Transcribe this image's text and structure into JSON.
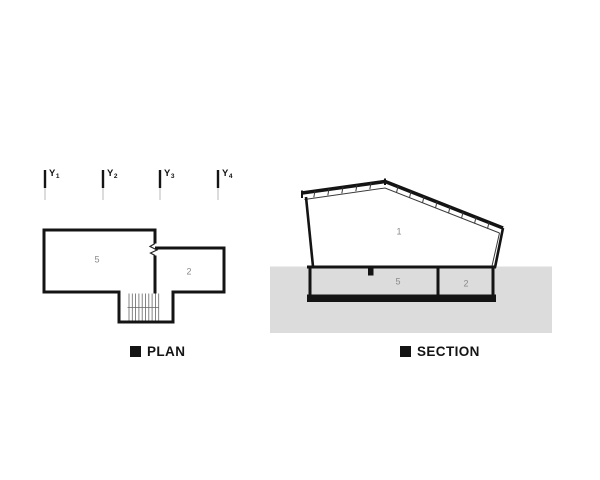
{
  "colors": {
    "ink": "#141414",
    "ground": "#dcdcdc",
    "room-label": "#8a8a8a",
    "grid-thin": "#b8b8b8"
  },
  "grid": {
    "axes": [
      {
        "letter": "Y",
        "index": "1"
      },
      {
        "letter": "Y",
        "index": "2"
      },
      {
        "letter": "Y",
        "index": "3"
      },
      {
        "letter": "Y",
        "index": "4"
      }
    ]
  },
  "plan": {
    "caption": "PLAN",
    "rooms": [
      {
        "number": "5"
      },
      {
        "number": "2"
      }
    ]
  },
  "section": {
    "caption": "SECTION",
    "rooms": [
      {
        "number": "1"
      },
      {
        "number": "5"
      },
      {
        "number": "2"
      }
    ]
  }
}
